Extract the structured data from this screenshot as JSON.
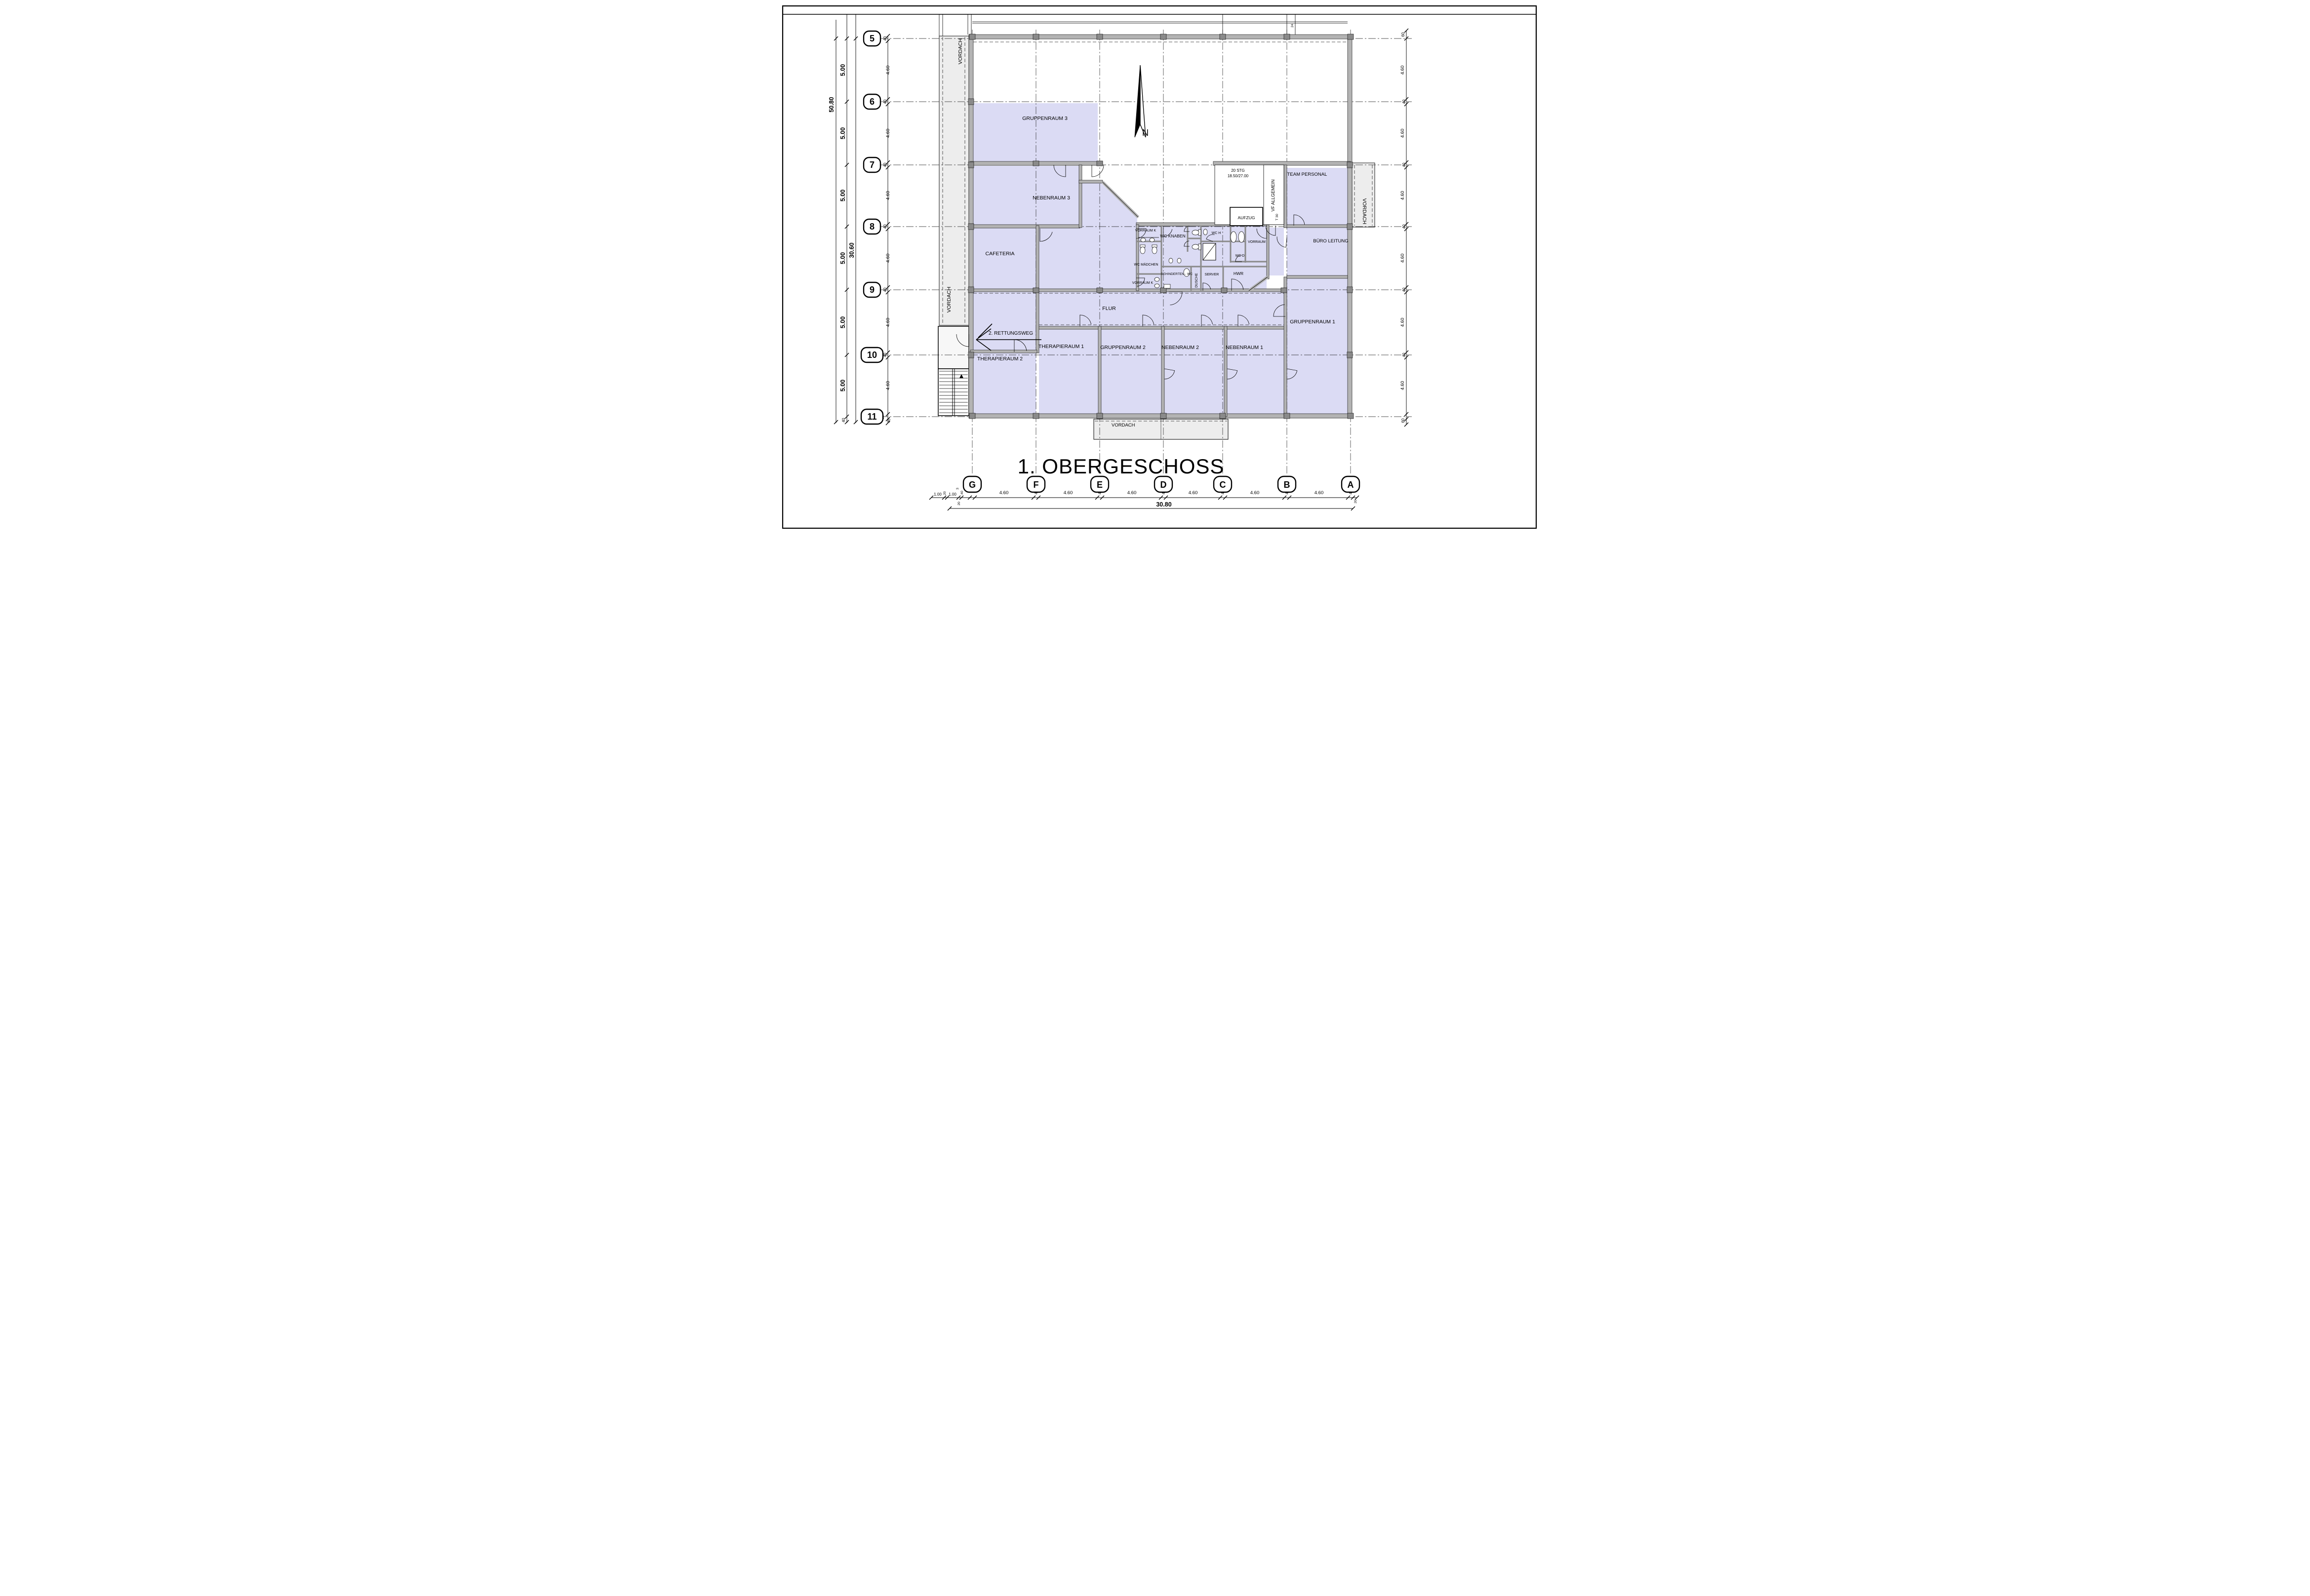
{
  "sheet": {
    "title": "1. OBERGESCHOSS"
  },
  "north": {
    "label": "N"
  },
  "grid": {
    "rows": [
      "5",
      "6",
      "7",
      "8",
      "9",
      "10",
      "11"
    ],
    "cols": [
      "G",
      "F",
      "E",
      "D",
      "C",
      "B",
      "A"
    ]
  },
  "rooms": {
    "gruppenraum3": "GRUPPENRAUM 3",
    "nebenraum3": "NEBENRAUM 3",
    "cafeteria": "CAFETERIA",
    "flur": "FLUR",
    "rettungsweg": "2. RETTUNGSWEG",
    "therapieraum1": "THERAPIERAUM 1",
    "therapieraum2": "THERAPIERAUM 2",
    "gruppenraum2": "GRUPPENRAUM 2",
    "nebenraum2": "NEBENRAUM 2",
    "nebenraum1": "NEBENRAUM 1",
    "gruppenraum1": "GRUPPENRAUM 1",
    "buero_leitung": "BÜRO LEITUNG",
    "team_personal": "TEAM PERSONAL",
    "aufzug": "AUFZUG",
    "vorraum_k_oben": "VORRAUM K",
    "wc_knaben": "WC KNABEN",
    "wc_maedchen": "WC MÄDCHEN",
    "vorraum_k_unten": "VORRAUM K",
    "behinderten_wc": "BEHINDERTEN - WC",
    "dusche": "DUSCHE",
    "server": "SERVER",
    "hwr": "HWR",
    "vorraum": "VORRAUM",
    "wc_d": "WC D",
    "wc_h": "WC H",
    "vf_allgemein": "VF ALLGEMEIN",
    "vordach": "VORDACH"
  },
  "stair": {
    "line1": "20 STG",
    "line2": "18.50/27.00",
    "door": "T 30"
  },
  "dimensions": {
    "left_total": "50.80",
    "left_inner_total": "30.60",
    "left_segments": [
      "5.00",
      "5.00",
      "5.00",
      "5.00",
      "5.00",
      "5.00"
    ],
    "left_segment_end": "40",
    "left_axis_widths": [
      "40",
      "40",
      "40",
      "40",
      "40",
      "40"
    ],
    "left_gaps": [
      "4.60",
      "4.60",
      "4.60",
      "4.60",
      "4.60",
      "4.60"
    ],
    "left_end_pair": [
      "20",
      "40"
    ],
    "right_chain": [
      "60",
      "4.60",
      "40",
      "4.60",
      "40",
      "4.60",
      "40",
      "4.60",
      "40",
      "4.60",
      "40",
      "4.60",
      "60"
    ],
    "bottom_cluster": [
      "1.00",
      "20",
      "1.00",
      "3",
      "40",
      "20"
    ],
    "bottom_gaps": [
      "4.60",
      "4.60",
      "4.60",
      "4.60",
      "4.60",
      "4.60"
    ],
    "bottom_axis_widths": [
      "40",
      "40",
      "40",
      "40",
      "40",
      "40"
    ],
    "bottom_end": "20",
    "bottom_total": "30.80",
    "railing_width": "24"
  }
}
